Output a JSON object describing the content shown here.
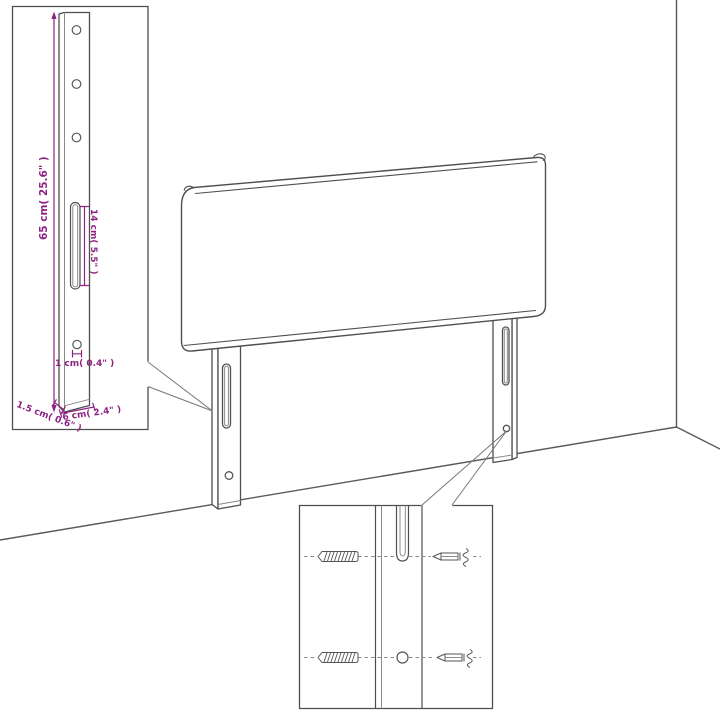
{
  "title": "Headboard with legs - dimension diagram",
  "colors": {
    "line": "#4f4f4f",
    "light_line": "#8a8a8a",
    "dimension_accent": "#8d2383",
    "background": "#ffffff"
  },
  "dimension_labels": {
    "height": "65 cm( 25.6\" )",
    "slot_length": "14 cm( 5.5\" )",
    "hole_diameter": "1 cm( 0.4\" )",
    "thickness": "1.5 cm( 0.6\" )",
    "width": "6 cm( 2.4\" )"
  }
}
